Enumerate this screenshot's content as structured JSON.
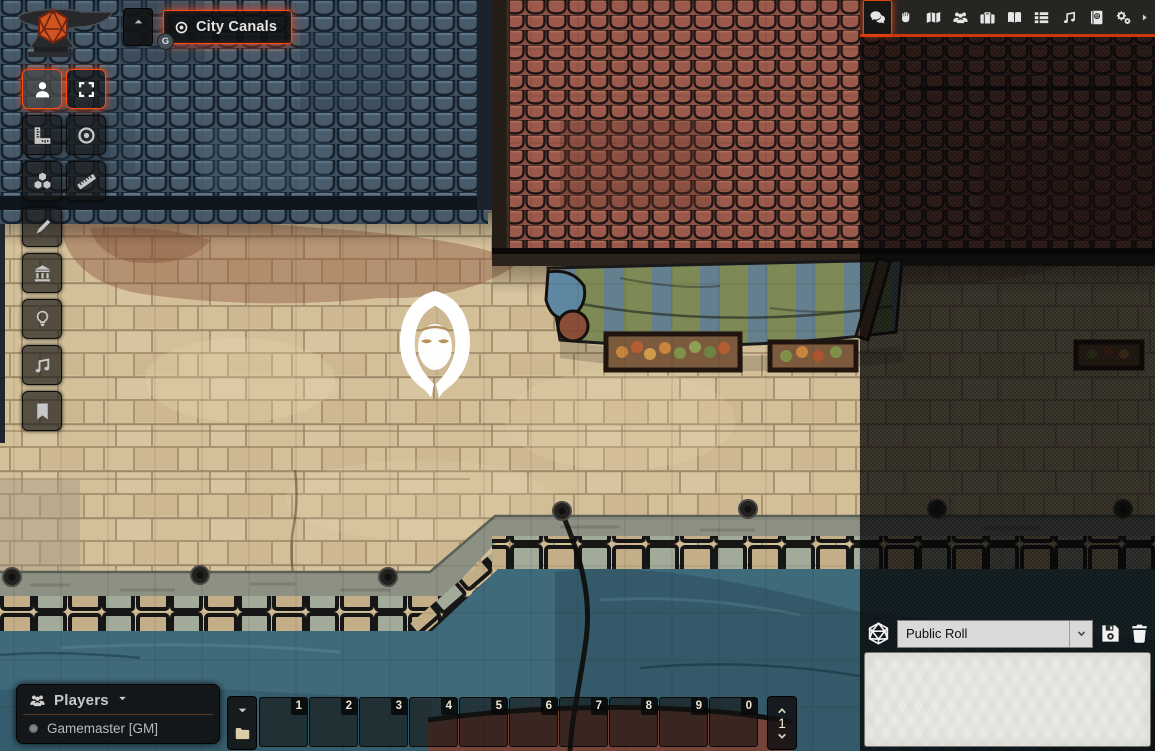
{
  "scene_nav": {
    "collapse_icon": "caret-up-icon",
    "active_scene": {
      "label": "City Canals",
      "icon": "bullseye-icon",
      "badge": "G"
    }
  },
  "toolbar": {
    "controls": [
      {
        "name": "token-controls",
        "icon": "user-icon",
        "active": true
      },
      {
        "name": "measure-templates",
        "icon": "ruler-combined-icon",
        "active": false
      },
      {
        "name": "tile-controls",
        "icon": "cubes-icon",
        "active": false
      },
      {
        "name": "drawing-tools",
        "icon": "pencil-icon",
        "active": false
      },
      {
        "name": "wall-controls",
        "icon": "university-icon",
        "active": false
      },
      {
        "name": "lighting-controls",
        "icon": "lightbulb-icon",
        "active": false
      },
      {
        "name": "sound-controls",
        "icon": "music-icon",
        "active": false
      },
      {
        "name": "journal-notes",
        "icon": "bookmark-icon",
        "active": false
      }
    ],
    "tools": [
      {
        "name": "select-tokens",
        "icon": "expand-icon",
        "active": true
      },
      {
        "name": "target-token",
        "icon": "bullseye-icon",
        "active": false
      },
      {
        "name": "measure-distance",
        "icon": "ruler-icon",
        "active": false
      }
    ]
  },
  "sidebar": {
    "tabs": [
      {
        "name": "chat",
        "icon": "comments-icon",
        "active": true
      },
      {
        "name": "combat",
        "icon": "fist-icon",
        "active": false
      },
      {
        "name": "scenes",
        "icon": "map-icon",
        "active": false
      },
      {
        "name": "actors",
        "icon": "users-icon",
        "active": false
      },
      {
        "name": "items",
        "icon": "suitcase-icon",
        "active": false
      },
      {
        "name": "journal",
        "icon": "book-open-icon",
        "active": false
      },
      {
        "name": "tables",
        "icon": "list-icon",
        "active": false
      },
      {
        "name": "playlists",
        "icon": "music-icon",
        "active": false
      },
      {
        "name": "compendium",
        "icon": "atlas-icon",
        "active": false
      },
      {
        "name": "settings",
        "icon": "cogs-icon",
        "active": false
      }
    ],
    "collapse_icon": "caret-right-icon"
  },
  "chat": {
    "dice_icon": "d20-icon",
    "roll_type": {
      "value": "Public Roll"
    },
    "save_icon": "save-icon",
    "delete_icon": "trash-icon",
    "input": {
      "value": ""
    }
  },
  "players": {
    "title": "Players",
    "icon": "users-icon",
    "collapse_icon": "caret-down-icon",
    "list": [
      {
        "name": "Gamemaster [GM]",
        "status_dot": "gray"
      }
    ]
  },
  "hotbar": {
    "slots": [
      "1",
      "2",
      "3",
      "4",
      "5",
      "6",
      "7",
      "8",
      "9",
      "0"
    ],
    "page": "1",
    "controls": {
      "collapse_icon": "caret-down-icon",
      "folder_icon": "folder-icon"
    },
    "page_icons": [
      "chevron-up-icon",
      "chevron-down-icon"
    ]
  },
  "canvas": {
    "token_icon": "hooded-figure",
    "grid_size_px": 47
  },
  "colors": {
    "accent_orange": "#ff4a17",
    "tab_underline": "#c9390d",
    "water": "#3f6a7a",
    "street": "#d3c099",
    "roof_blue": "#42566a",
    "roof_red": "#96564a",
    "awning_green": "#7e8a55",
    "awning_blue": "#64808f",
    "chat_input_bg": "#eae9e4",
    "select_bg": "#d9d9d9"
  }
}
